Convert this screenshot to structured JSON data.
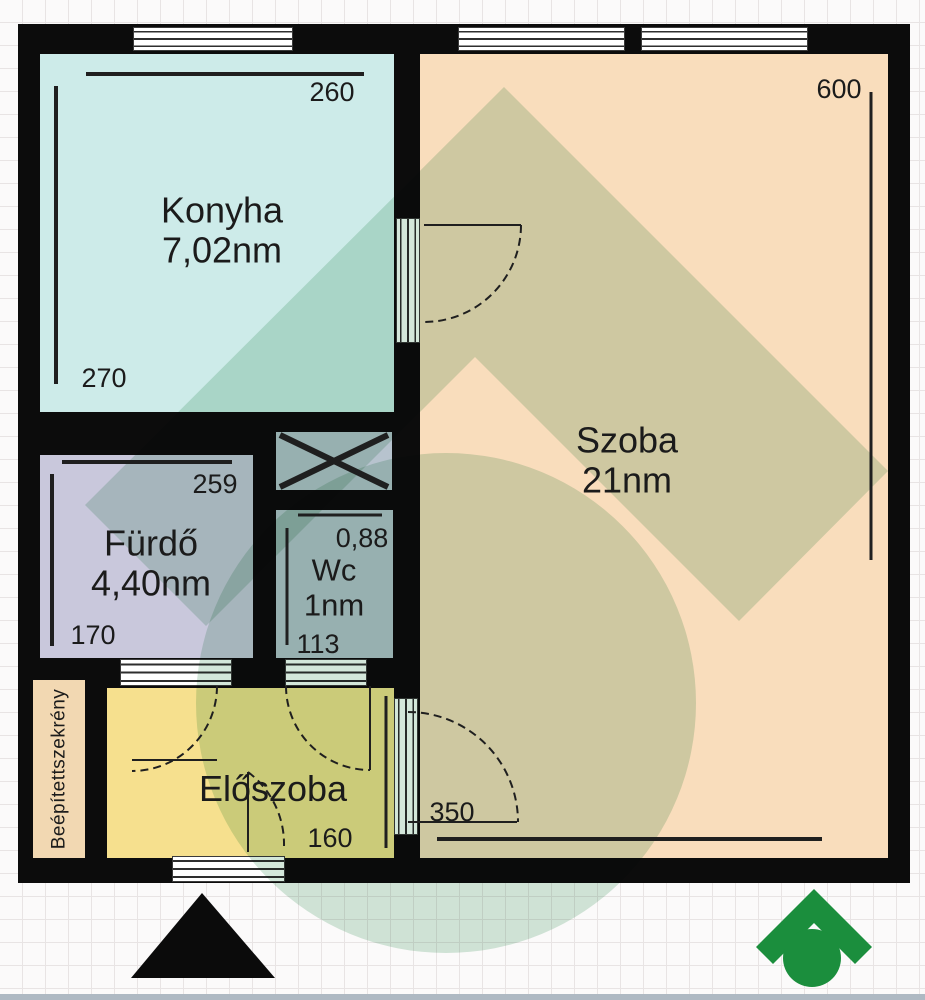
{
  "title": "Apartment floor plan",
  "rooms": {
    "konyha": {
      "name": "Konyha",
      "area": "7,02nm",
      "dim_width": "260",
      "dim_height": "270"
    },
    "szoba": {
      "name": "Szoba",
      "area": "21nm",
      "dim_height": "600",
      "dim_door": "350"
    },
    "furdo": {
      "name": "Fürdő",
      "area": "4,40nm",
      "dim_width": "259",
      "dim_height": "170"
    },
    "wc": {
      "name": "Wc",
      "area": "1nm",
      "dim_width": "0,88",
      "dim_height": "113"
    },
    "eloszoba": {
      "name": "Előszoba",
      "dim_width": "160"
    },
    "szekreny": {
      "name": "Beépítettszekrény"
    }
  },
  "colors": {
    "wall": "#0c0c0c",
    "konyha": "#cdebe9",
    "szoba": "#f9ddbc",
    "furdo": "#c9c8dc",
    "wc_and_shaft": "#b7c3ce",
    "eloszoba": "#f6e08e",
    "szekreny": "#f2d8b2",
    "watermark_tint": "#d3e7da",
    "logo_green": "#1b8e3d",
    "grid_line": "#e8e4e4",
    "bottom_strip": "#aeb9c3"
  },
  "icons": {
    "north_arrow": "black-triangle-north-indicator",
    "brand_logo": "green-roof-and-dot-house-logo",
    "watermark": "large-roof-and-circle-watermark",
    "shaft_symbol": "x-cross-duct-shaft"
  }
}
